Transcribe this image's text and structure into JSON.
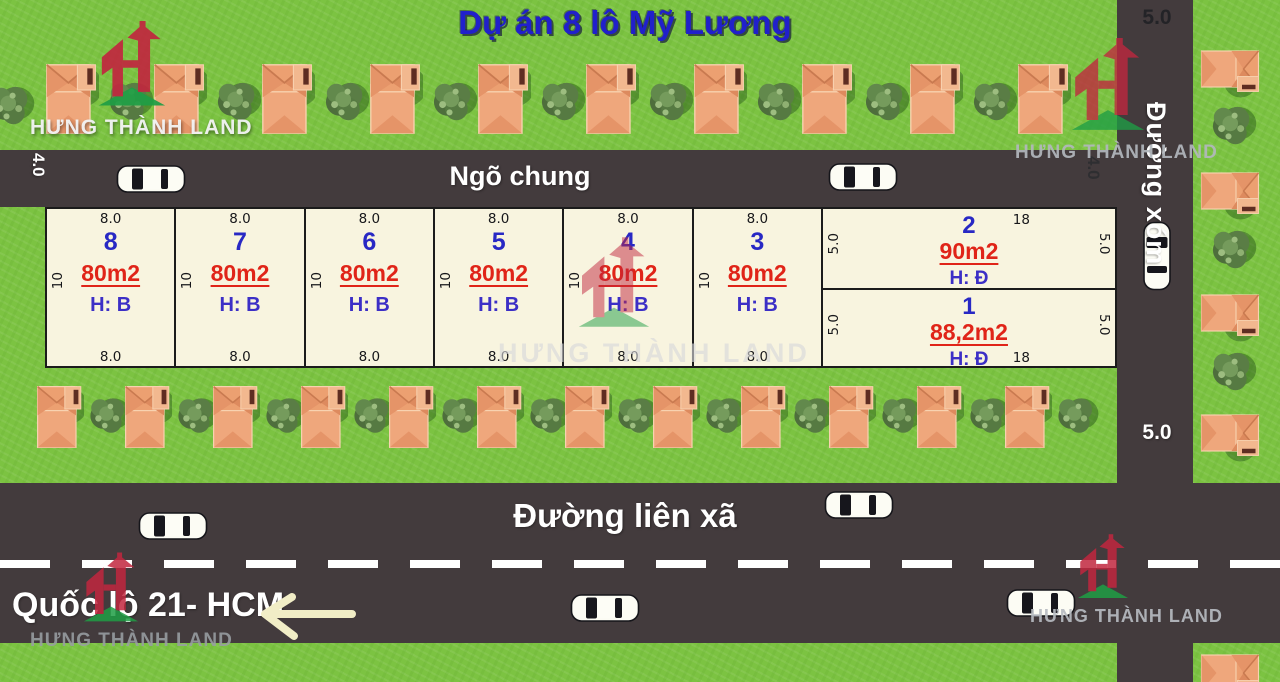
{
  "title": "Dự án 8 lô Mỹ Lương",
  "watermark": {
    "text": "HƯNG THÀNH LAND"
  },
  "roads": {
    "alley": {
      "name": "Ngõ chung",
      "width_label_left": "4.0",
      "width_label_right": "4.0"
    },
    "hamlet": {
      "name": "Đường xóm",
      "width_label_top": "5.0",
      "width_label_mid": "5.0"
    },
    "commune": {
      "name": "Đường liên xã"
    },
    "highway": {
      "name": "Quốc lộ 21- HCM"
    }
  },
  "plots": [
    {
      "id": "8",
      "area": "80m2",
      "house_direction": "H: B",
      "front": "8.0",
      "back": "8.0",
      "depth": "10"
    },
    {
      "id": "7",
      "area": "80m2",
      "house_direction": "H: B",
      "front": "8.0",
      "back": "8.0",
      "depth": "10"
    },
    {
      "id": "6",
      "area": "80m2",
      "house_direction": "H: B",
      "front": "8.0",
      "back": "8.0",
      "depth": "10"
    },
    {
      "id": "5",
      "area": "80m2",
      "house_direction": "H: B",
      "front": "8.0",
      "back": "8.0",
      "depth": "10"
    },
    {
      "id": "4",
      "area": "80m2",
      "house_direction": "H: B",
      "front": "8.0",
      "back": "8.0",
      "depth": "10"
    },
    {
      "id": "3",
      "area": "80m2",
      "house_direction": "H: B",
      "front": "8.0",
      "back": "8.0",
      "depth": "10"
    },
    {
      "id": "2",
      "area": "90m2",
      "house_direction": "H: Đ",
      "long_side": "18",
      "depth_left": "5.0",
      "depth_right": "5.0"
    },
    {
      "id": "1",
      "area": "88,2m2",
      "house_direction": "H: Đ",
      "long_side": "18",
      "depth_left": "5.0",
      "depth_right": "5.0"
    }
  ],
  "icons": {
    "house": "house-icon",
    "tree": "tree-icon",
    "car": "car-icon",
    "brand_logo": "hung-thanh-land-logo-icon",
    "direction_arrow": "left-arrow-icon"
  },
  "colors": {
    "grass": "#7cc342",
    "road": "#433b3d",
    "plot_fill": "#f8f4df",
    "plot_border": "#1b1b1b",
    "title_blue": "#2120cb",
    "plot_number_blue": "#2828c4",
    "area_red": "#e02418",
    "direction_blue": "#3c2fc6",
    "road_text": "#ffffff",
    "arrow_cream": "#f1edc6",
    "brand_red": "#c1273f",
    "brand_green": "#1f9e45"
  },
  "scenery": {
    "houses_top_row": 10,
    "houses_bottom_row": 12,
    "houses_right_column": 5,
    "cars_total": 7
  }
}
